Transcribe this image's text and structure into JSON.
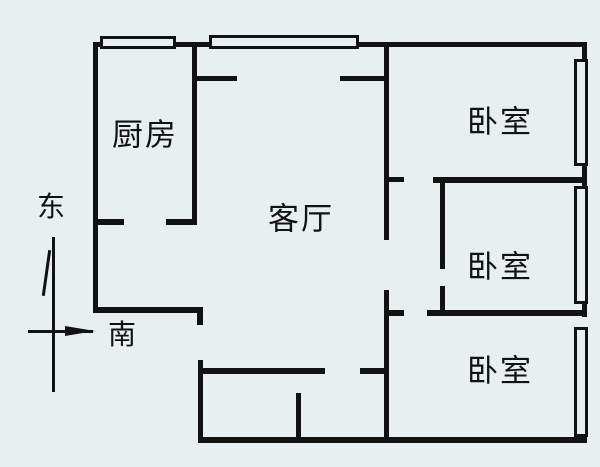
{
  "colors": {
    "background": "#e8eff0",
    "line": "#121212"
  },
  "rooms": {
    "kitchen": {
      "label": "厨房"
    },
    "living_room": {
      "label": "客厅"
    },
    "bedroom_1": {
      "label": "卧室"
    },
    "bedroom_2": {
      "label": "卧室"
    },
    "bedroom_3": {
      "label": "卧室"
    }
  },
  "compass": {
    "east": "东",
    "south": "南"
  }
}
